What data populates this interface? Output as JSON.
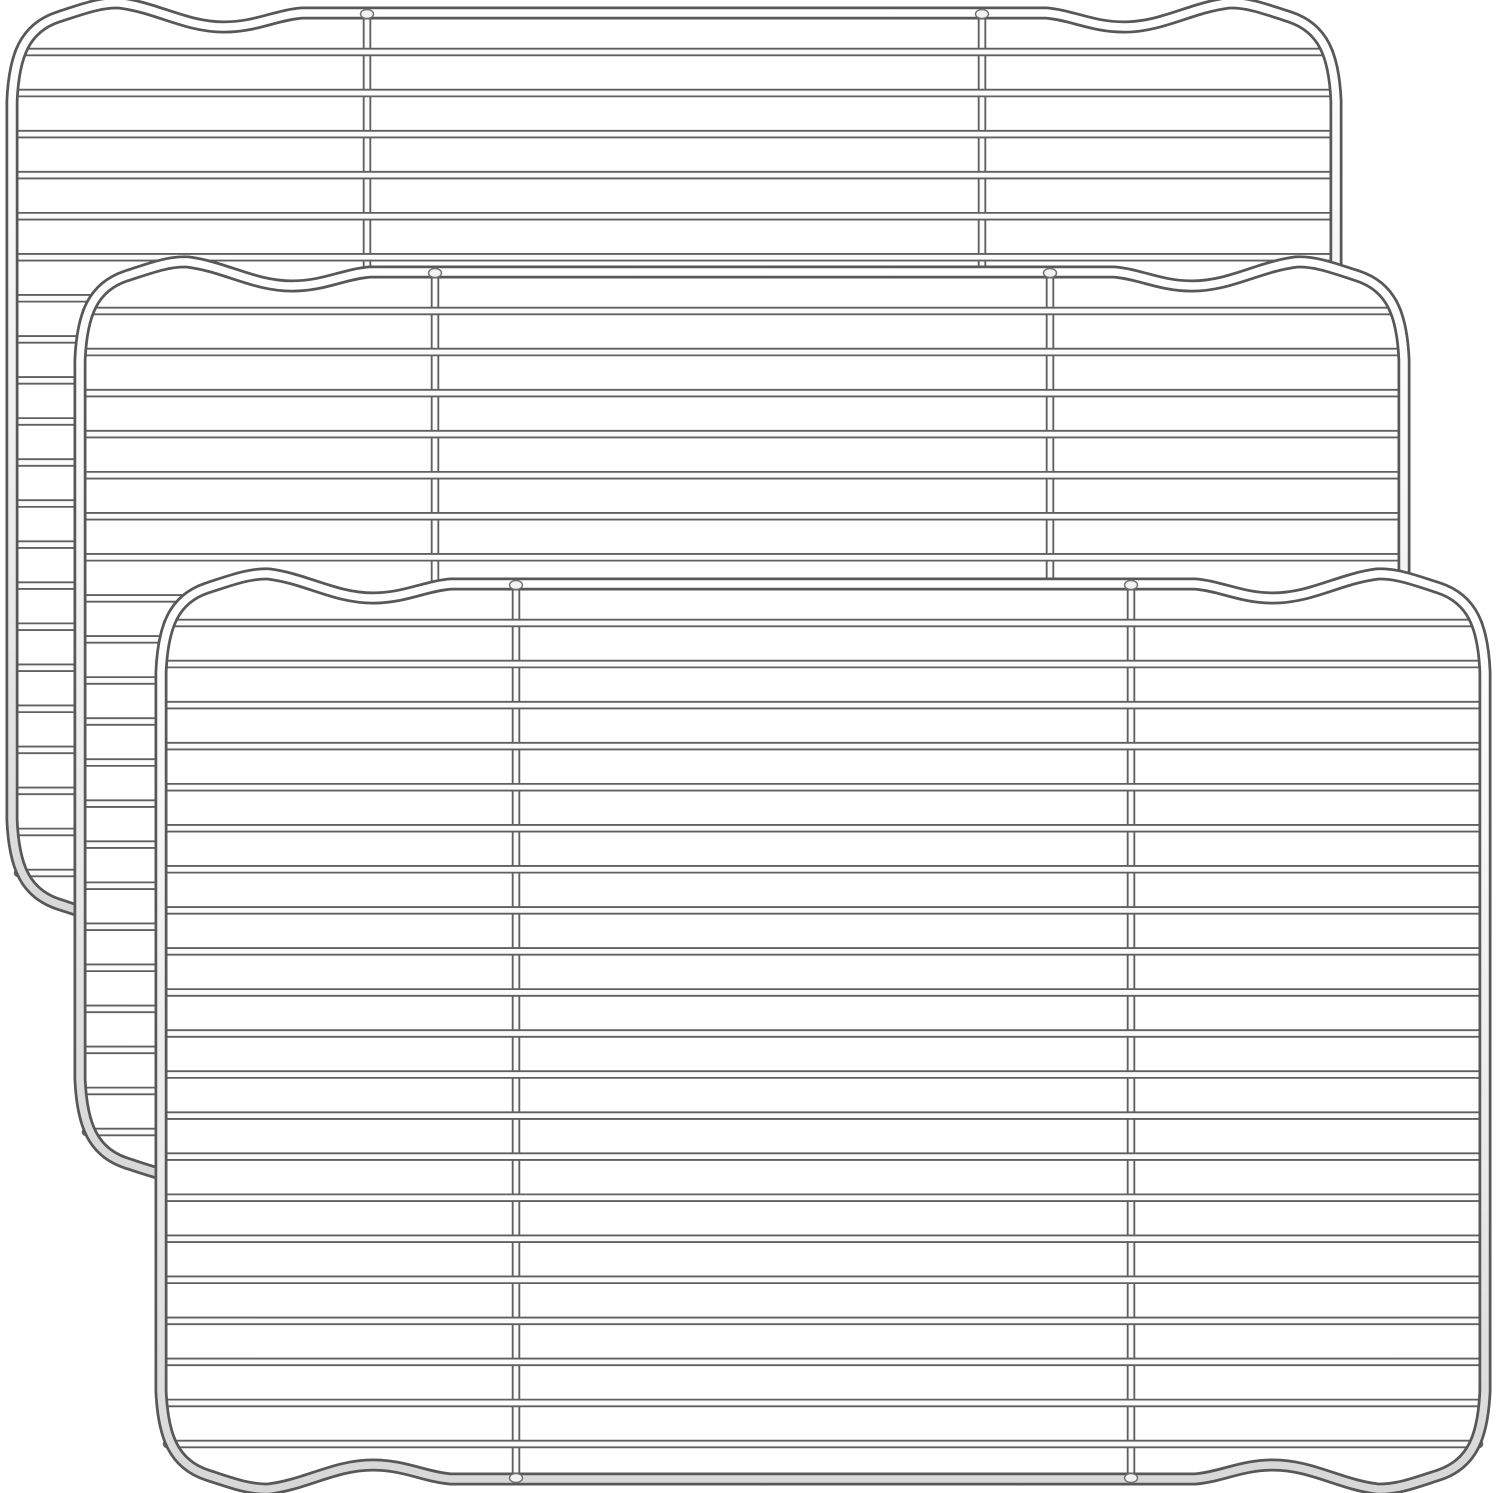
{
  "product_image": {
    "description": "three-stainless-steel-wire-cooling-racks-stacked-diagonally",
    "background_color": "#ffffff",
    "canvas": {
      "width": 1500,
      "height": 1493
    },
    "colors": {
      "background": "#ffffff",
      "wire_outline": "#606060",
      "wire_core": "#fbfbfb",
      "frame_outline": "#585858",
      "frame_core_gradient": [
        "#ffffff",
        "#f4f4f4",
        "#e9e9e9",
        "#d7d7d7"
      ],
      "weld_fill": "#f2f2f2",
      "weld_outline": "#707070"
    },
    "rack_geometry": {
      "width": 1324,
      "height": 895,
      "corner_radius": 88,
      "bump": {
        "peak_x": 108,
        "peak_rise": 11,
        "valley_x": 212,
        "valley_drop": 14,
        "end_x": 290
      },
      "horizontal_wires": 21,
      "first_wire_offset": 39,
      "wire_spacing": 41.05,
      "vertical_wires": [
        355,
        970
      ],
      "frame_outline_width": 13,
      "frame_core_width": 7.5,
      "wire_outline_width": 8.5,
      "wire_core_width": 4.8
    },
    "racks": [
      {
        "name": "cooling-rack-back",
        "x": 12,
        "y": 13
      },
      {
        "name": "cooling-rack-middle",
        "x": 80,
        "y": 272
      },
      {
        "name": "cooling-rack-front",
        "x": 161,
        "y": 584
      }
    ]
  }
}
